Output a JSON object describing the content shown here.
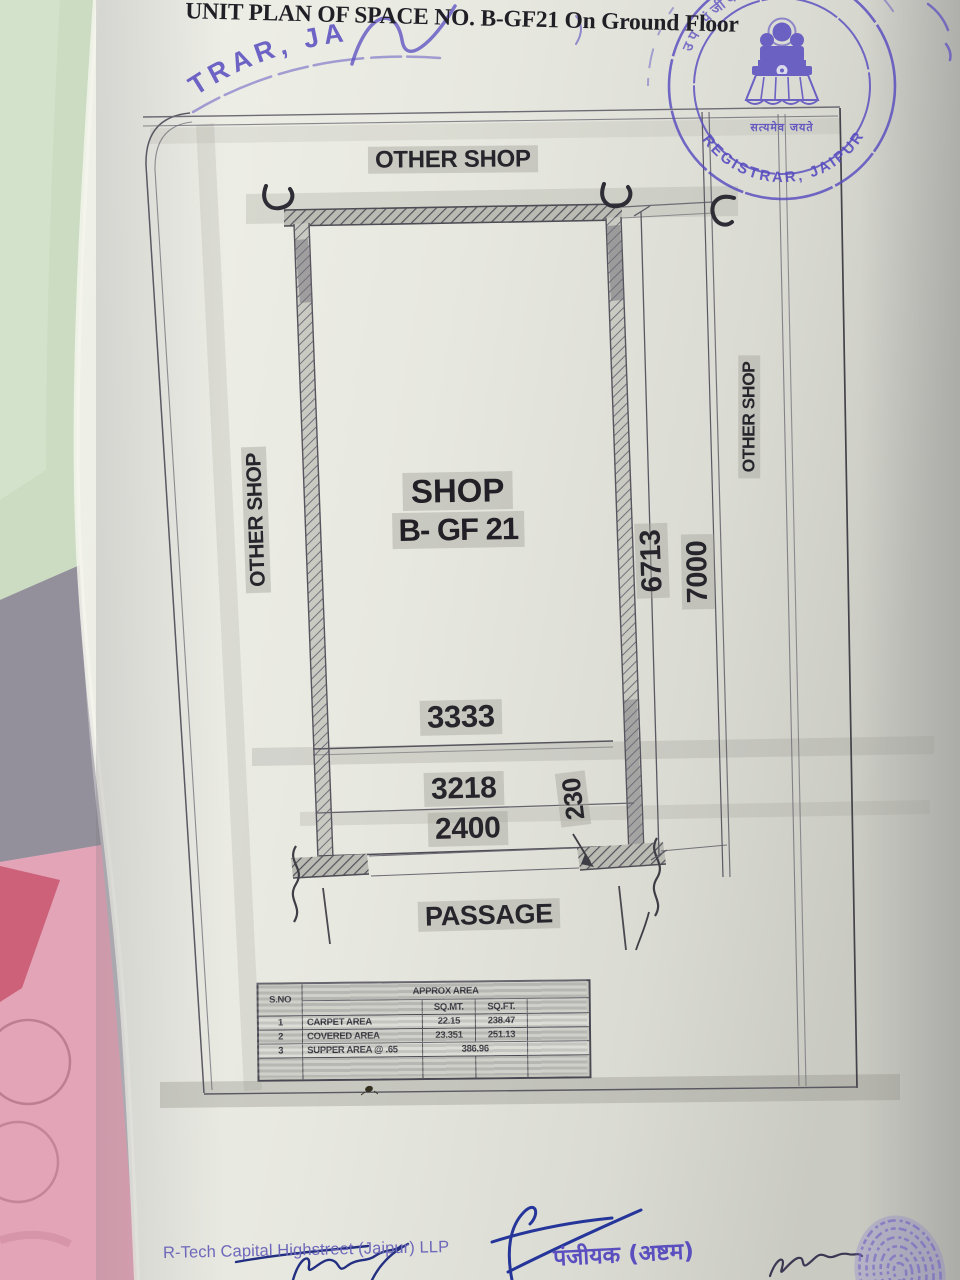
{
  "title": "UNIT PLAN OF SPACE NO. B-GF21 On Ground Floor",
  "stamp": {
    "arc_top": "उप पंजीयक जयपुर",
    "arc_bottom": "REGISTRAR, JAIPUR",
    "banner": "सत्यमेव जयते",
    "partial_left": "TRAR, JA",
    "color": "#584cc0"
  },
  "plan": {
    "labels": {
      "other_shop_top": "OTHER SHOP",
      "other_shop_left": "OTHER SHOP",
      "other_shop_right": "OTHER SHOP",
      "shop_line1": "SHOP",
      "shop_line2": "B- GF 21",
      "passage": "PASSAGE"
    },
    "dimensions": {
      "width_inner": "3333",
      "width_mid": "3218",
      "width_opening": "2400",
      "wall_offset": "230",
      "depth_inner": "6713",
      "depth_outer": "7000"
    }
  },
  "area_table": {
    "title": "APPROX AREA",
    "col_sno": "S.NO",
    "col_sqmt": "SQ.MT.",
    "col_sqft": "SQ.FT.",
    "rows": [
      {
        "sno": "1",
        "name": "CARPET AREA",
        "sqmt": "22.15",
        "sqft": "238.47"
      },
      {
        "sno": "2",
        "name": "COVERED AREA",
        "sqmt": "23.351",
        "sqft": "251.13"
      },
      {
        "sno": "3",
        "name": "SUPPER AREA @ .65",
        "value": "386.96"
      }
    ]
  },
  "footer": {
    "company": "R-Tech Capital Highstreet (Jaipur) LLP",
    "registrar_hindi": "पंजीयक (अष्टम)"
  },
  "colors": {
    "paper": "#e8e9e1",
    "stamp_purple": "#584cc0",
    "pen_blue": "#25359a",
    "pencil_grey": "#57545e",
    "highlight_grey": "#a3a59b",
    "backdrop_green": "#cbdcc3",
    "backdrop_pink": "#e2a4b6",
    "backdrop_lavender": "#93909b"
  }
}
